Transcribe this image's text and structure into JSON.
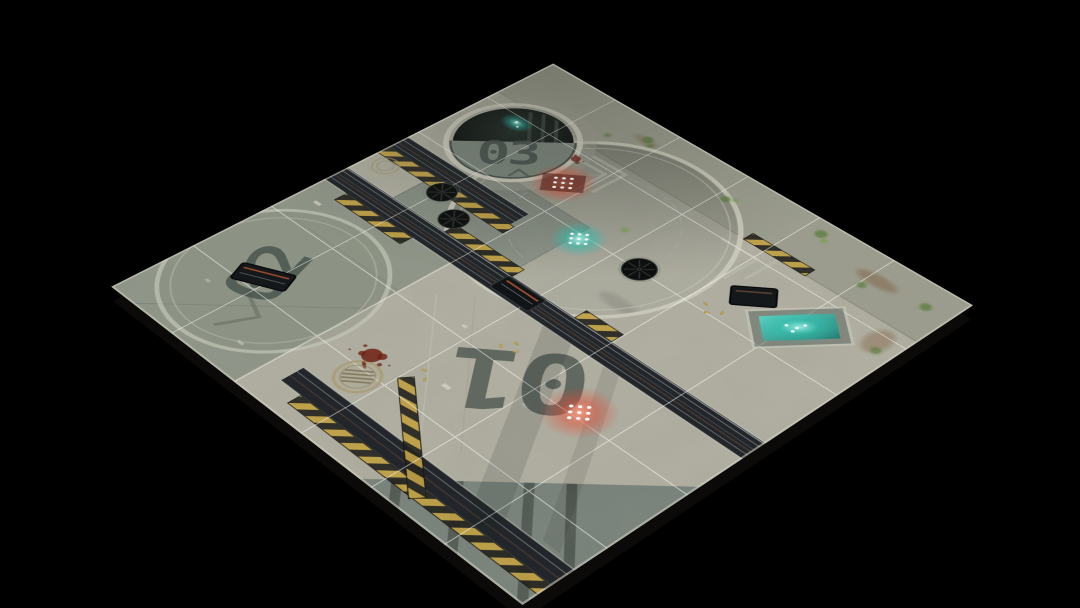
{
  "mat": {
    "zones": {
      "zone_01": "01",
      "zone_02": "02",
      "zone_03": "03"
    },
    "grid": {
      "rows": 6,
      "cols": 6
    },
    "lights": {
      "red_count": 2,
      "teal_count": 2
    },
    "colors": {
      "background": "#000000",
      "concrete_light": "#b2b0a2",
      "concrete_weathered": "#9a9b8b",
      "plate_olive": "#8b9284",
      "plate_dark": "#757f78",
      "trench_dark": "#22262a",
      "hazard_yellow": "#c0a144",
      "hazard_black": "#26241f",
      "ring_light": "#cdcbbc",
      "glow_teal": "#45e0cf",
      "glow_red": "#ff6a55",
      "dot_white": "#ffffff",
      "moss_green": "#5f7f41",
      "blood_red": "#6e2114",
      "rust_brown": "#7a5236",
      "brass_yellow": "#c9a952",
      "stencil_dark": "#46514b",
      "grid_white": "#ffffff"
    }
  }
}
